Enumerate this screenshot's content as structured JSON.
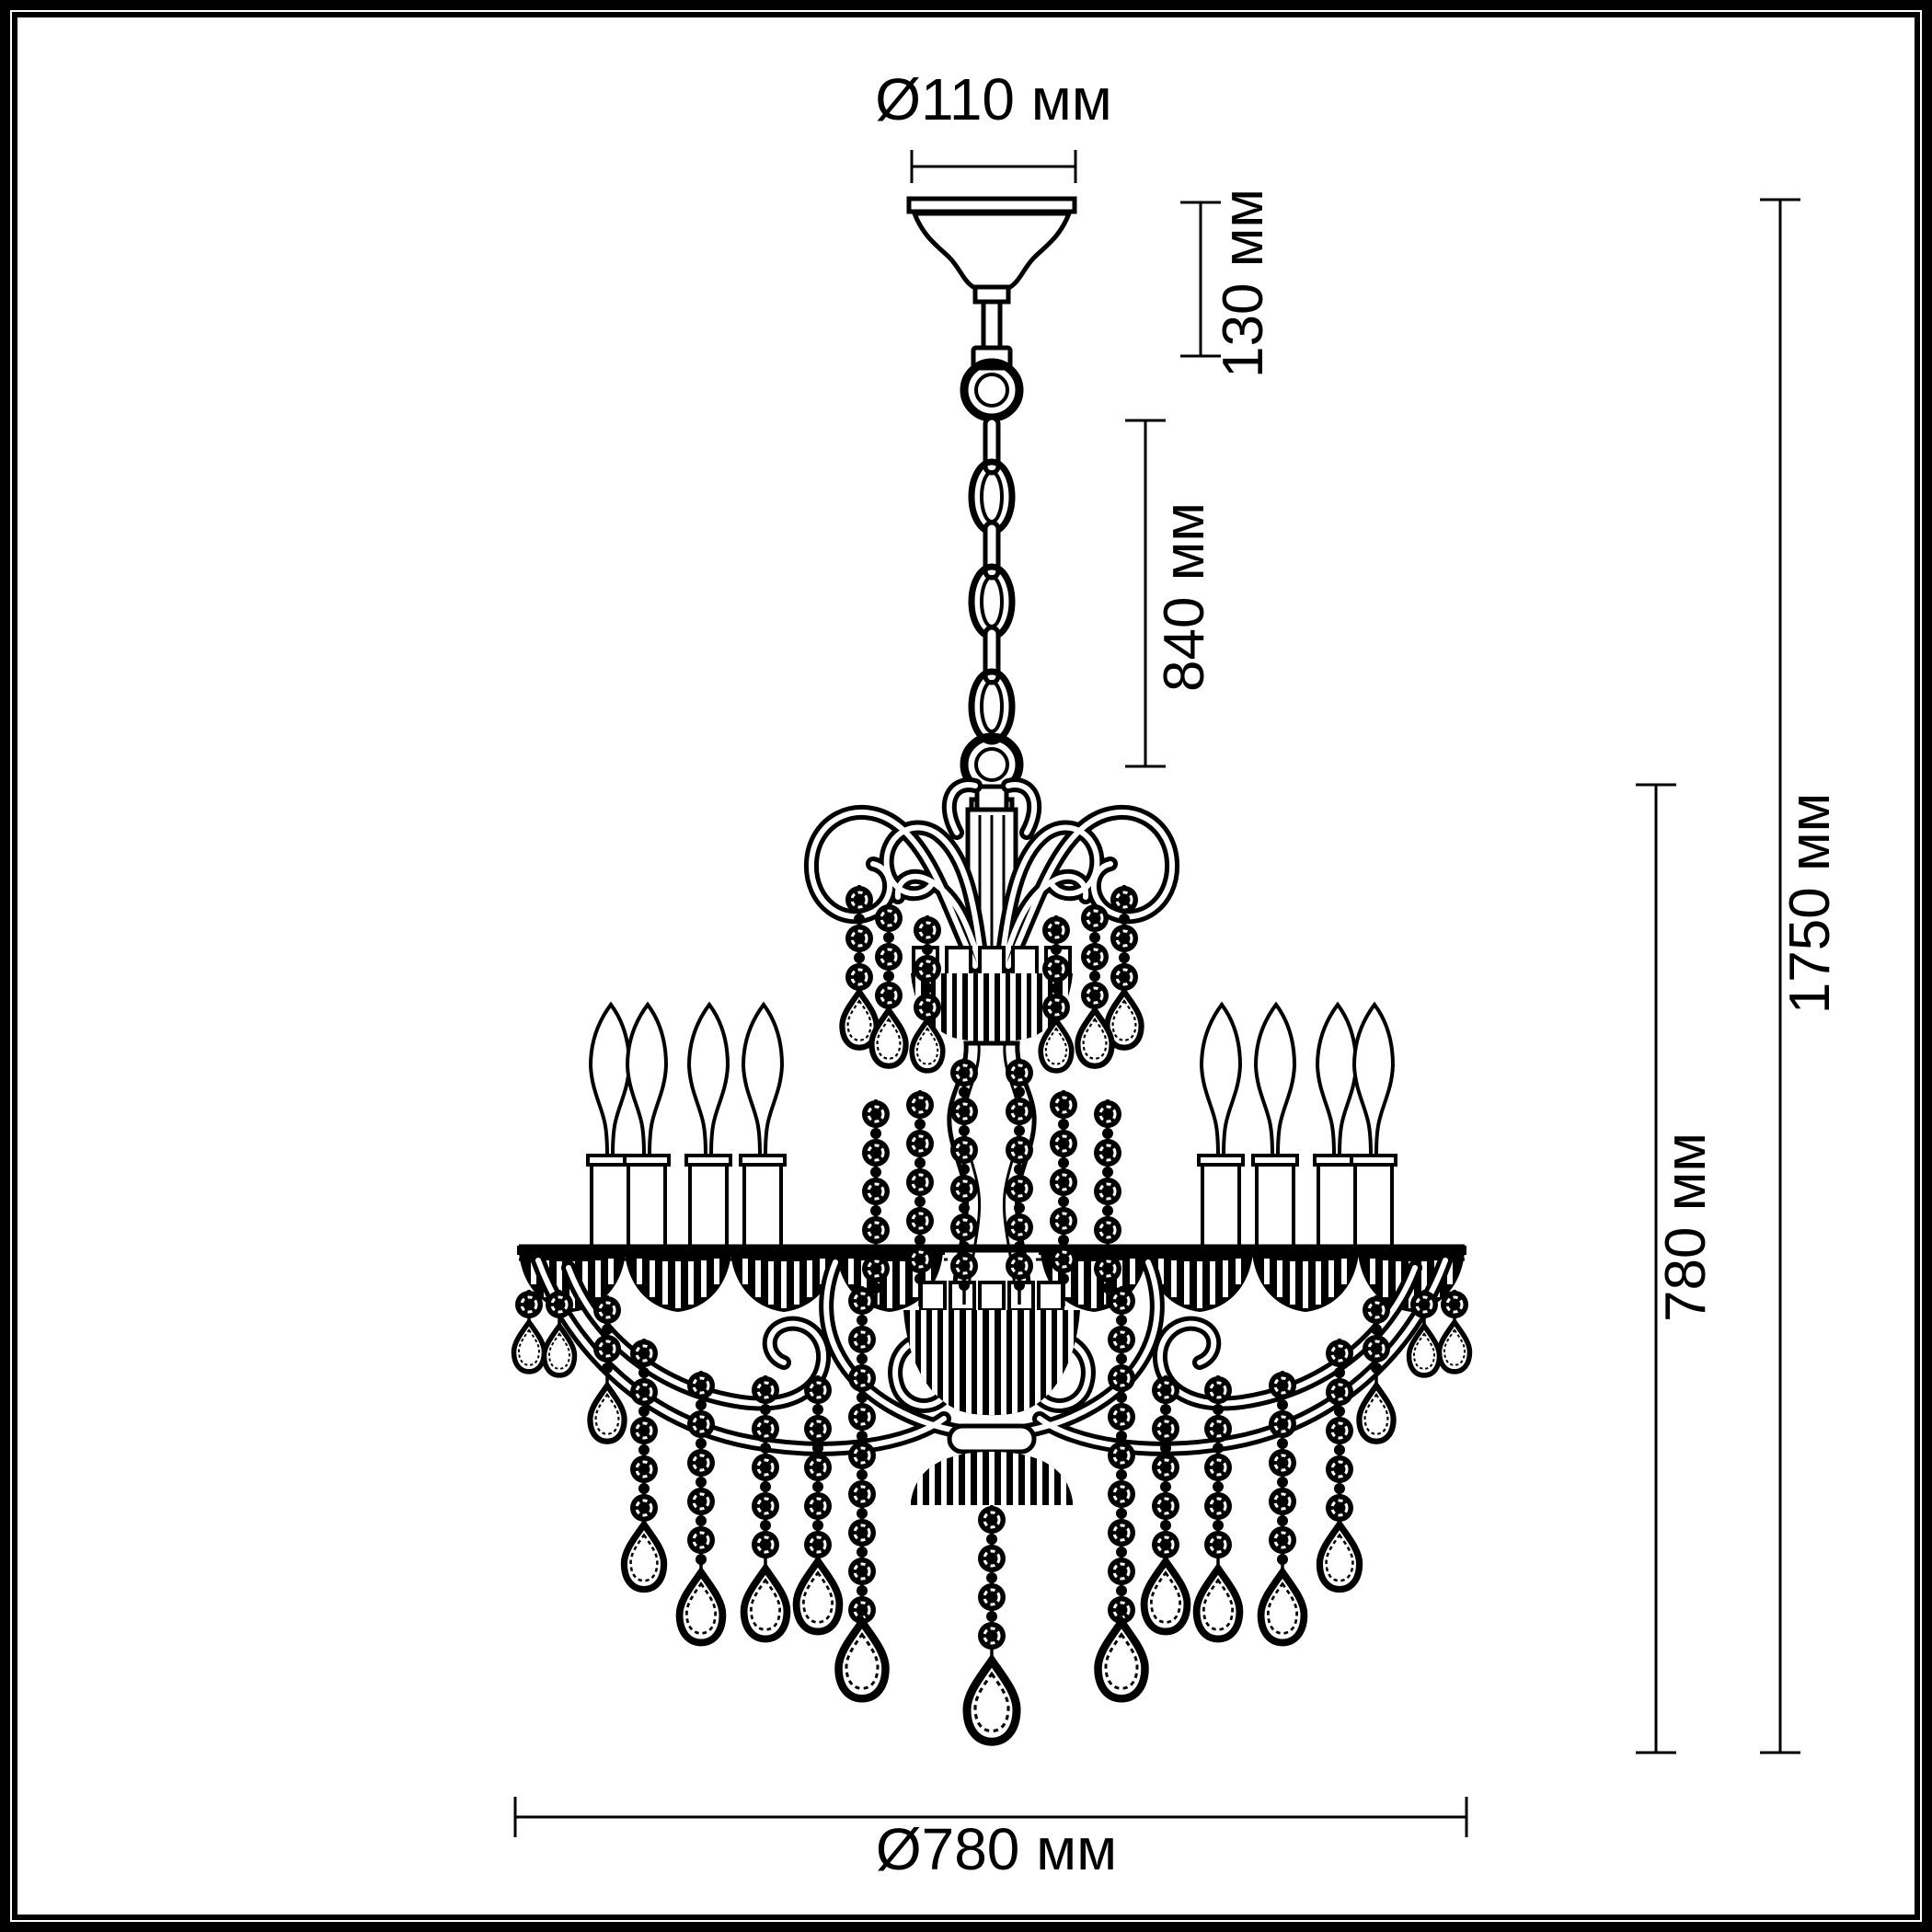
{
  "figure": {
    "kind": "chandelier technical dimension drawing",
    "background_color": "#ffffff",
    "line_color": "#000000",
    "candles_visible": 8,
    "chain_oval_links": 3
  },
  "units": "мм",
  "dimensions": {
    "canopy_diameter": {
      "label": "Ø110 мм",
      "value_mm": 110
    },
    "canopy_height": {
      "label": "130 мм",
      "value_mm": 130
    },
    "chain_length": {
      "label": "840 мм",
      "value_mm": 840
    },
    "total_height": {
      "label": "1750 мм",
      "value_mm": 1750
    },
    "body_height": {
      "label": "780 мм",
      "value_mm": 780
    },
    "body_diameter": {
      "label": "Ø780 мм",
      "value_mm": 780
    }
  }
}
